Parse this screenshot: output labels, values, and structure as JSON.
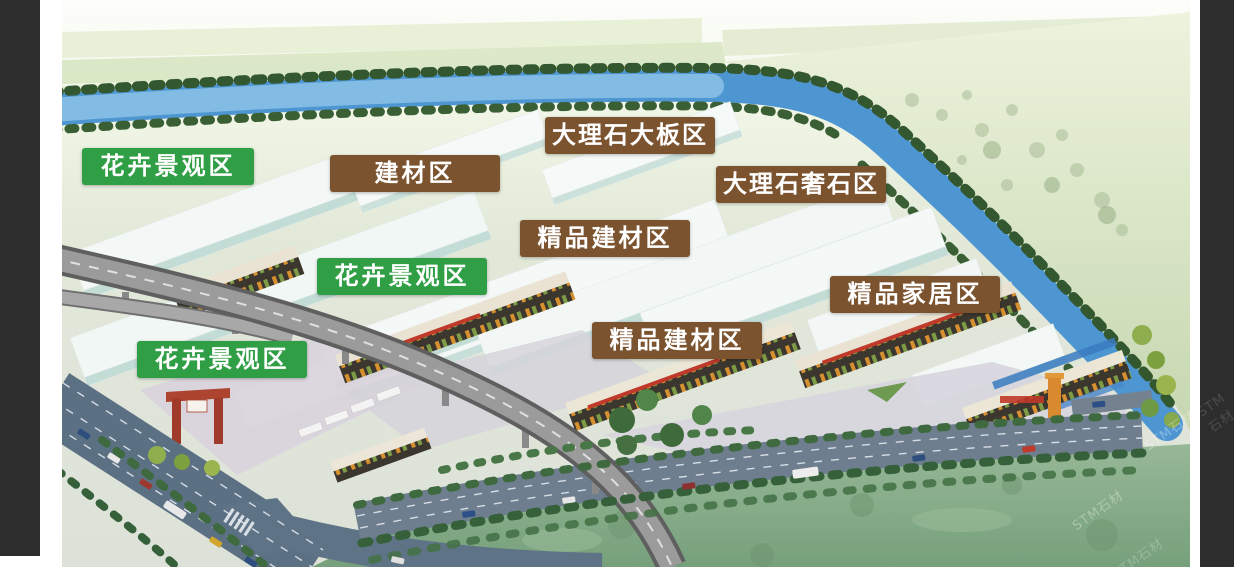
{
  "page": {
    "background": "#ffffff",
    "side_panel_color": "#2e2e2e"
  },
  "colors": {
    "label_green": "#2f9e44",
    "label_brown": "#7b532f",
    "label_text": "#ffffff",
    "river_blue": "#4e96d2",
    "field_green": "#d8e6c2",
    "lawn_green": "#7aa37e",
    "road_gray": "#5f7286",
    "plaza_gray": "#d8d5de",
    "warehouse_roof": "#f3f8f6",
    "warehouse_wall": "#c3dcd6",
    "market_dark": "#3b372f",
    "viaduct_gray": "#9b9b9b"
  },
  "labels": [
    {
      "id": "flower-landscape-zone-1",
      "text": "花卉景观区",
      "type": "green"
    },
    {
      "id": "building-materials-zone",
      "text": "建材区",
      "type": "brown"
    },
    {
      "id": "marble-slab-zone",
      "text": "大理石大板区",
      "type": "brown"
    },
    {
      "id": "marble-luxury-stone-zone",
      "text": "大理石奢石区",
      "type": "brown"
    },
    {
      "id": "boutique-building-materials-zone-1",
      "text": "精品建材区",
      "type": "brown"
    },
    {
      "id": "flower-landscape-zone-2",
      "text": "花卉景观区",
      "type": "green"
    },
    {
      "id": "boutique-home-furnishing-zone",
      "text": "精品家居区",
      "type": "brown"
    },
    {
      "id": "boutique-building-materials-zone-2",
      "text": "精品建材区",
      "type": "brown"
    },
    {
      "id": "flower-landscape-zone-3",
      "text": "花卉景观区",
      "type": "green"
    }
  ],
  "watermark": {
    "text": "STM石材"
  }
}
